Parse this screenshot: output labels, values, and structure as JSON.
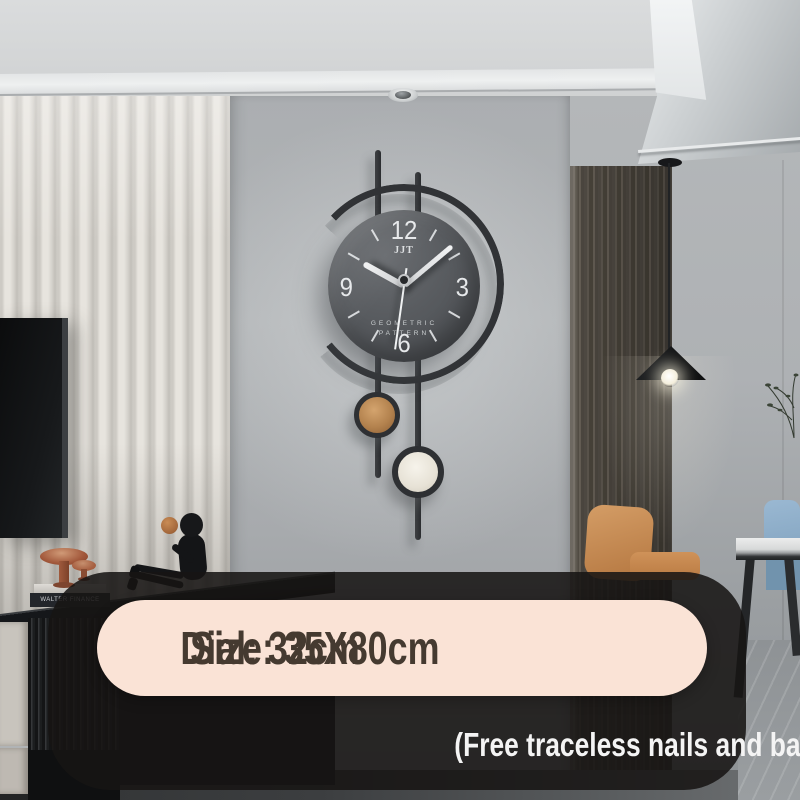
{
  "banner": {
    "dial": "Dial: 32cm",
    "size": "Size: 35X80cm",
    "note": "(Free traceless nails and batteries)"
  },
  "clock": {
    "brand": "JJT",
    "label_line1": "GEOMETRIC",
    "label_line2": "PATTERN",
    "numerals": [
      "12",
      "3",
      "6",
      "9"
    ],
    "time_shown": "10:08"
  },
  "decor": {
    "book_spine": "WALTER FINANCE"
  },
  "colors": {
    "pill_bg": "#fae3d6",
    "pill_text": "#453a30",
    "note_text": "#f4f4f4",
    "overlay": "rgba(23,21,20,0.87)",
    "clock_frame": "#313336",
    "clock_dial": "#55585c",
    "pendulum_copper": "#b3824e",
    "pendulum_cream": "#eee9df",
    "wood_panel": "#524c45",
    "accent_chair_tan": "#c58850",
    "accent_chair_blue": "#8fb0cb"
  }
}
